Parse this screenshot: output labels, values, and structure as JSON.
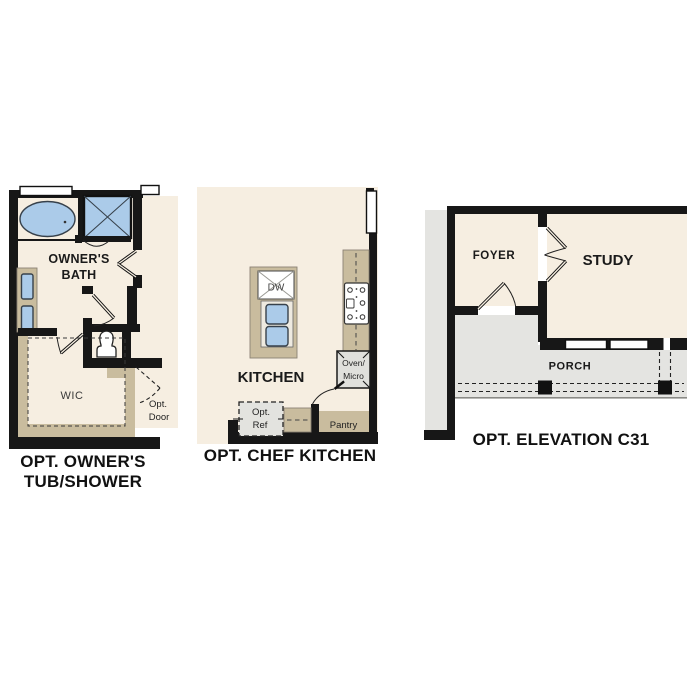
{
  "document": {
    "background": "#ffffff",
    "type": "floor-plan-options-sheet"
  },
  "colors": {
    "floor_cream": "#f6eee1",
    "wall_black": "#171717",
    "fixture_blue": "#abcbe9",
    "cabinet_tan": "#c9bc9e",
    "porch_gray": "#e4e4e1",
    "appliance_gray": "#e0e0dc",
    "label_text": "#1a1a1a"
  },
  "panels": {
    "owners_bath": {
      "caption_line1": "OPT. OWNER'S",
      "caption_line2": "TUB/SHOWER",
      "room_label_line1": "OWNER'S",
      "room_label_line2": "BATH",
      "wic_label": "WIC",
      "opt_door_line1": "Opt.",
      "opt_door_line2": "Door",
      "fixtures": [
        "bathtub",
        "shower",
        "double-vanity-sinks",
        "toilet",
        "windows",
        "door-swings"
      ]
    },
    "chef_kitchen": {
      "caption": "OPT. CHEF KITCHEN",
      "room_label": "KITCHEN",
      "dishwasher_label": "DW",
      "oven_label_line1": "Oven/",
      "oven_label_line2": "Micro",
      "ref_label_line1": "Opt.",
      "ref_label_line2": "Ref",
      "pantry_label": "Pantry",
      "fixtures": [
        "kitchen-island",
        "double-sink",
        "dishwasher",
        "cooktop",
        "oven-microwave",
        "optional-refrigerator",
        "pantry-closet",
        "window"
      ]
    },
    "elevation_c31": {
      "caption": "OPT. ELEVATION C31",
      "foyer_label": "FOYER",
      "study_label": "STUDY",
      "porch_label": "PORCH",
      "fixtures": [
        "french-doors",
        "entry-door",
        "porch-columns",
        "windows"
      ]
    }
  }
}
